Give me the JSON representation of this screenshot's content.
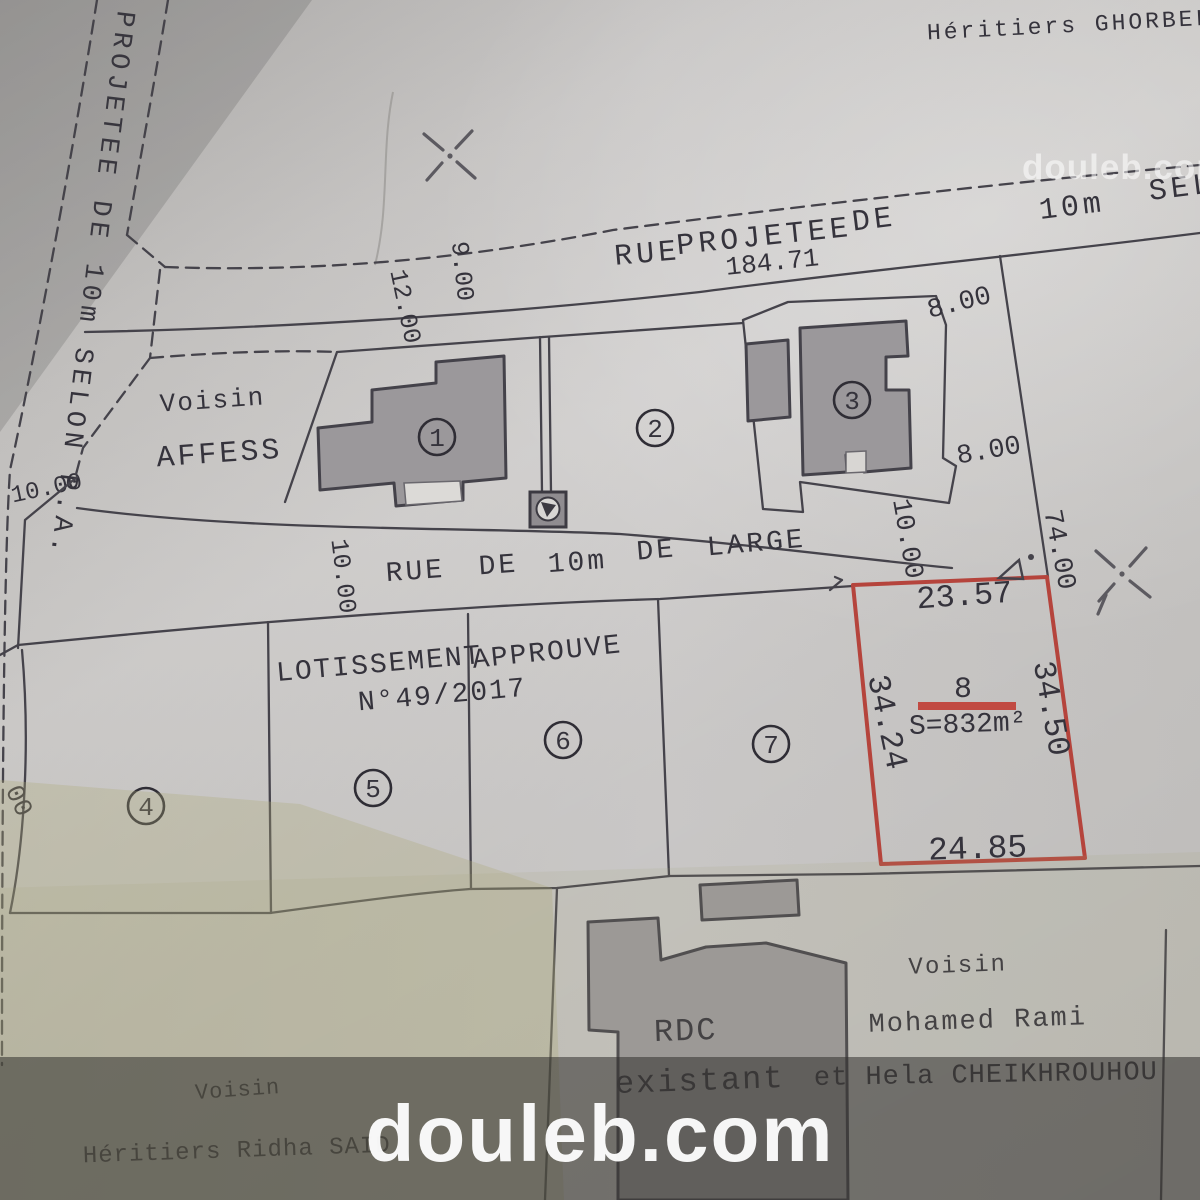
{
  "photo": {
    "paper_color": "#cdcbc9",
    "ink_color": "#45434b",
    "accent_red": "#b5443c",
    "band_color": "rgba(50,48,45,0.55)",
    "olive_tint": "#aca876"
  },
  "watermarks": {
    "top_right": "douleb.com",
    "bottom_center": "douleb.com"
  },
  "neighbors": {
    "north": "Héritiers GHORBEL",
    "west_line1": "Voisin",
    "west_line2": "AFFESS",
    "southeast_line1": "Voisin",
    "southeast_line2": "Mohamed Rami",
    "southeast_line3": "et Hela CHEIKHROUHOU",
    "southwest_line1": "Voisin",
    "southwest_line2": "Héritiers Ridha SAID"
  },
  "roads": {
    "west_vertical": {
      "label": "PROJETEE DE 10m SELON P.A."
    },
    "north": {
      "words": [
        "RUE",
        "PROJETEE",
        "DE",
        "10m",
        "SELON"
      ],
      "length": "184.71"
    },
    "middle": {
      "words": [
        "RUE",
        "DE",
        "10m",
        "DE",
        "LARGE"
      ]
    }
  },
  "subdivision": {
    "title_word1": "LOTISSEMENT",
    "title_word2": "APPROUVE",
    "number": "N°49/2017"
  },
  "parcels": {
    "p1": "1",
    "p2": "2",
    "p3": "3",
    "p4": "4",
    "p5": "5",
    "p6": "6",
    "p7": "7"
  },
  "lot8": {
    "number": "8",
    "area": "S=832m²",
    "side_top": "23.57",
    "side_left": "34.24",
    "side_right": "34.50",
    "side_bottom": "24.85"
  },
  "dims": {
    "w9": "9.00",
    "w12": "12.00",
    "e8a": "8.00",
    "e8b": "8.00",
    "e10": "10.00",
    "e74": "74.00",
    "m10_road_end": "10.00",
    "m10_left": "10.00",
    "nw10": "10.00",
    "partial00": "00"
  },
  "existing_building": {
    "line1": "RDC",
    "line2": "existant"
  }
}
